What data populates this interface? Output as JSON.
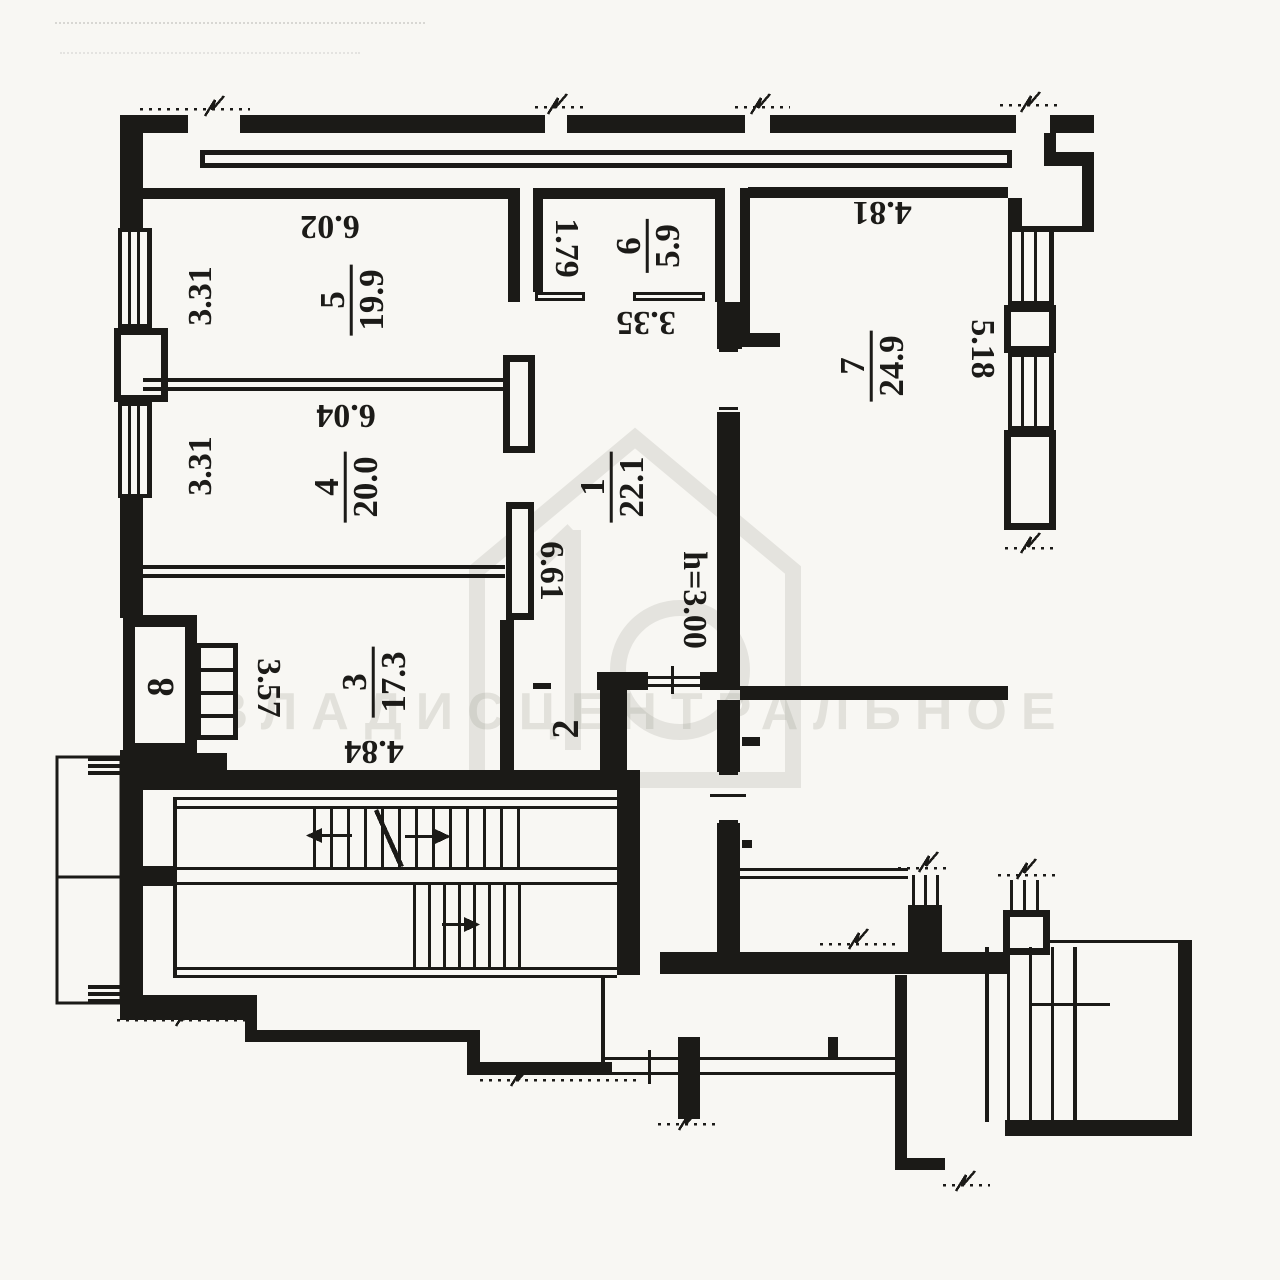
{
  "watermark": {
    "text": "ВЛАДИСЦЕНТРАЛЬНОЕ",
    "color": "#96948a"
  },
  "labels": {
    "height_note": "h=3.00",
    "dims": {
      "w602": "6.02",
      "w331a": "3.31",
      "w331b": "3.31",
      "w179": "1.79",
      "w335": "3.35",
      "w481": "4.81",
      "w518": "5.18",
      "w604": "6.04",
      "w661": "6.61",
      "w357": "3.57",
      "w484": "4.84"
    },
    "rooms": {
      "r1": {
        "number": "1",
        "area": "22.1"
      },
      "r2": {
        "number": "2"
      },
      "r3": {
        "number": "3",
        "area": "17.3"
      },
      "r4": {
        "number": "4",
        "area": "20.0"
      },
      "r5": {
        "number": "5",
        "area": "19.9"
      },
      "r6": {
        "number": "6",
        "area": "5.9"
      },
      "r7": {
        "number": "7",
        "area": "24.9"
      },
      "r8": {
        "number": "8"
      }
    }
  }
}
